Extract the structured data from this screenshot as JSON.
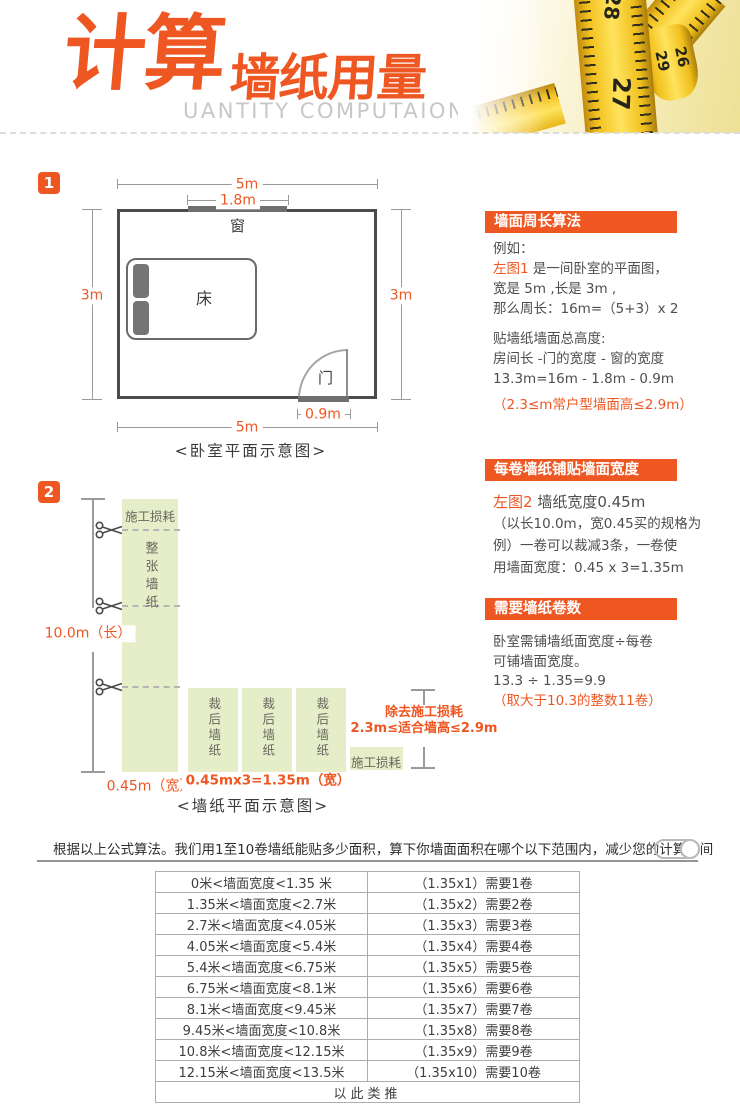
{
  "colors": {
    "accent": "#ee5622",
    "light_green": "#e6eec9"
  },
  "header": {
    "title_cn_main": "计算",
    "title_cn_sub": "墙纸用量",
    "title_en": "UANTITY COMPUTAION",
    "tape_numbers": [
      "28",
      "31",
      "29",
      "26",
      "27"
    ]
  },
  "section1": {
    "badge": "1",
    "room": {
      "window_label": "窗",
      "bed_label": "床",
      "door_label": "门"
    },
    "dims": {
      "top": "5m",
      "window": "1.8m",
      "left": "3m",
      "right": "3m",
      "door": "0.9m",
      "bottom": "5m"
    },
    "caption": "<卧室平面示意图>"
  },
  "panel1": {
    "title": "墙面周长算法",
    "line1": "例如：",
    "line2_hl": "左图1",
    "line2_rest": " 是一间卧室的平面图，",
    "line3": "宽是 5m ,长是 3m ,",
    "line4": "那么周长：16m=（5+3）x 2",
    "line5": "贴墙纸墙面总高度:",
    "line6": "房间长 -门的宽度 - 窗的宽度",
    "line7": "13.3m=16m - 1.8m - 0.9m",
    "note": "（2.3≤m常户型墙面高≤2.9m）"
  },
  "section2": {
    "badge": "2",
    "strip_top_label": "施工损耗",
    "strip_body_label": "整张墙纸",
    "cut_strip_label": "裁后墙纸",
    "loss_label": "施工损耗",
    "dim_length": "10.0m（长）",
    "dim_width": "0.45m（宽）",
    "dim_total_width": "0.45mx3=1.35m（宽）",
    "right_note_line1": "除去施工损耗",
    "right_note_line2": "2.3m≤适合墙高≤2.9m",
    "caption": "<墙纸平面示意图>"
  },
  "panel2": {
    "title": "每卷墙纸铺贴墙面宽度",
    "line1_hl": "左图2",
    "line1_rest": " 墙纸宽度0.45m",
    "line2": "（以长10.0m，宽0.45买的规格为",
    "line3": "例）一卷可以裁减3条，一卷使",
    "line4": "用墙面宽度：0.45 x 3=1.35m"
  },
  "panel3": {
    "title": "需要墙纸卷数",
    "line1": "卧室需铺墙纸面宽度÷每卷",
    "line2": "可铺墙面宽度。",
    "line3": "13.3 ÷ 1.35=9.9",
    "note": "（取大于10.3的整数11卷）"
  },
  "bottom": {
    "intro": "根据以上公式算法。我们用1至10卷墙纸能贴多少面积，算下你墙面面积在哪个以下范围内，减少您的计算时间",
    "table": {
      "rows": [
        {
          "range": "0米<墙面宽度<1.35 米",
          "rolls": "（1.35x1）需要1卷"
        },
        {
          "range": "1.35米<墙面宽度<2.7米",
          "rolls": "（1.35x2）需要2卷"
        },
        {
          "range": "2.7米<墙面宽度<4.05米",
          "rolls": "（1.35x3）需要3卷"
        },
        {
          "range": "4.05米<墙面宽度<5.4米",
          "rolls": "（1.35x4）需要4卷"
        },
        {
          "range": "5.4米<墙面宽度<6.75米",
          "rolls": "（1.35x5）需要5卷"
        },
        {
          "range": "6.75米<墙面宽度<8.1米",
          "rolls": "（1.35x6）需要6卷"
        },
        {
          "range": "8.1米<墙面宽度<9.45米",
          "rolls": "（1.35x7）需要7卷"
        },
        {
          "range": "9.45米<墙面宽度<10.8米",
          "rolls": "（1.35x8）需要8卷"
        },
        {
          "range": "10.8米<墙面宽度<12.15米",
          "rolls": "（1.35x9）需要9卷"
        },
        {
          "range": "12.15米<墙面宽度<13.5米",
          "rolls": "（1.35x10）需要10卷"
        }
      ],
      "footer": "以此类推"
    }
  }
}
